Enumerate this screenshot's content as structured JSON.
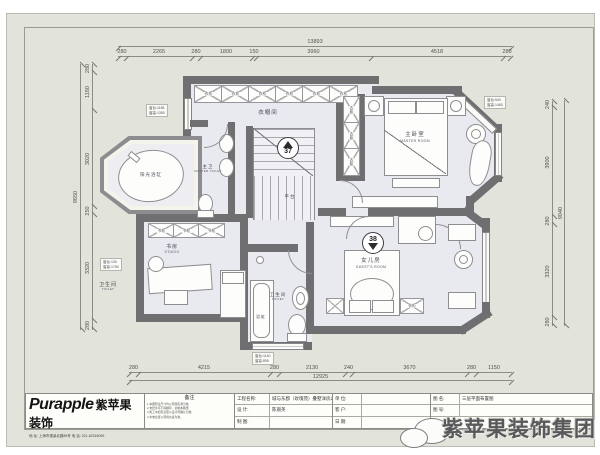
{
  "rooms": {
    "closet": {
      "cn": "衣帽间"
    },
    "master": {
      "cn": "主卧室",
      "en": "MASTER ROOM"
    },
    "master_toilet": {
      "cn": "主卫",
      "en": "MASTER TOILET"
    },
    "sun_tub": {
      "cn": "阳光浴缸"
    },
    "study": {
      "cn": "书房",
      "en": "STUDIO"
    },
    "bath": {
      "cn": "卫生间",
      "en": "TOILET"
    },
    "tub": {
      "cn": "浴缸"
    },
    "daughter": {
      "cn": "女儿房",
      "en": "GUEST'S ROOM"
    },
    "landing": {
      "cn": "平台"
    },
    "outside_toilet": {
      "cn": "卫生间",
      "en": "TOILET"
    }
  },
  "cabinets": {
    "wardrobe": "衣柜",
    "bookcase": "书柜"
  },
  "markers": {
    "stair_up": "37",
    "stair_down": "38"
  },
  "annotations": {
    "win_left_top": [
      "窗台:1185",
      "窗高:1350"
    ],
    "win_left_mid": [
      "窗台:130",
      "窗高:1750"
    ],
    "win_right_top": [
      "窗台:540",
      "窗高:1460"
    ],
    "win_bottom": [
      "窗台:1140",
      "窗高:855"
    ]
  },
  "dims": {
    "top": {
      "overall": "13893",
      "segments": [
        "280",
        "2265",
        "280",
        "1800",
        "150",
        "3960",
        "4518",
        "280"
      ]
    },
    "bottom": {
      "overall": "12925",
      "segments": [
        "280",
        "4215",
        "280",
        "2130",
        "240",
        "3670",
        "280",
        "1150"
      ]
    },
    "left": {
      "overall": "9650",
      "segments": [
        "280",
        "3320",
        "250",
        "3020",
        "1180",
        "280"
      ]
    },
    "right": {
      "overall": "9040",
      "segments": [
        "280",
        "3320",
        "280",
        "3900",
        "240"
      ]
    }
  },
  "title_block": {
    "logo_en": "Purapple",
    "logo_cn": "紫苹果装饰",
    "address": "地 址: 上海市漕溪北路88号  电 话: 021-62318099",
    "notes_title": "备注",
    "notes_lines": [
      "1.本图所注尺寸均以现场实测为准;",
      "2.未经许可不得翻印、复制本图纸;",
      "3.施工中如有变更以设计师确认为准;",
      "4.水电位置以现场交底为准。"
    ],
    "fields": [
      {
        "label": "工程名称:",
        "value": "城与东郡（玫瑰苑）叠墅洋房2F"
      },
      {
        "label": "设 计:",
        "value": "陈丽英"
      },
      {
        "label": "制 图:",
        "value": ""
      },
      {
        "label": "单 位:",
        "value": ""
      },
      {
        "label": "客 户:",
        "value": ""
      },
      {
        "label": "日 期:",
        "value": ""
      },
      {
        "label": "图 名:",
        "value": "三层平面布置图"
      },
      {
        "label": "图 号:",
        "value": ""
      }
    ]
  },
  "watermark": {
    "text": "紫苹果装饰集团"
  }
}
